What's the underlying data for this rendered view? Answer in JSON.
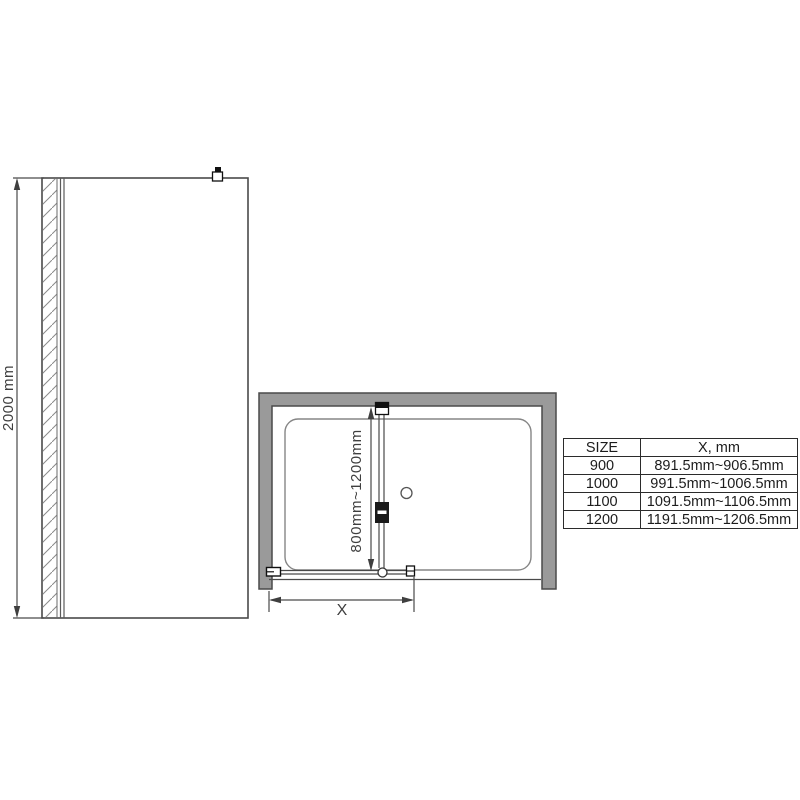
{
  "diagram": {
    "title": "shower-panel-dimension-drawing",
    "front_view": {
      "height_dimension": "2000 mm"
    },
    "plan_view": {
      "depth_dimension": "800mm~1200mm",
      "width_dimension": "X"
    }
  },
  "size_table": {
    "headers": [
      "SIZE",
      "X, mm"
    ],
    "rows": [
      {
        "size": "900",
        "x_range": "891.5mm~906.5mm"
      },
      {
        "size": "1000",
        "x_range": "991.5mm~1006.5mm"
      },
      {
        "size": "1100",
        "x_range": "1091.5mm~1106.5mm"
      },
      {
        "size": "1200",
        "x_range": "1191.5mm~1206.5mm"
      }
    ]
  },
  "colors": {
    "line": "#434343",
    "wall_fill": "#9a9a9a",
    "hatch": "#8a8a8a",
    "table_border": "#2b2b2b",
    "background": "#ffffff"
  }
}
